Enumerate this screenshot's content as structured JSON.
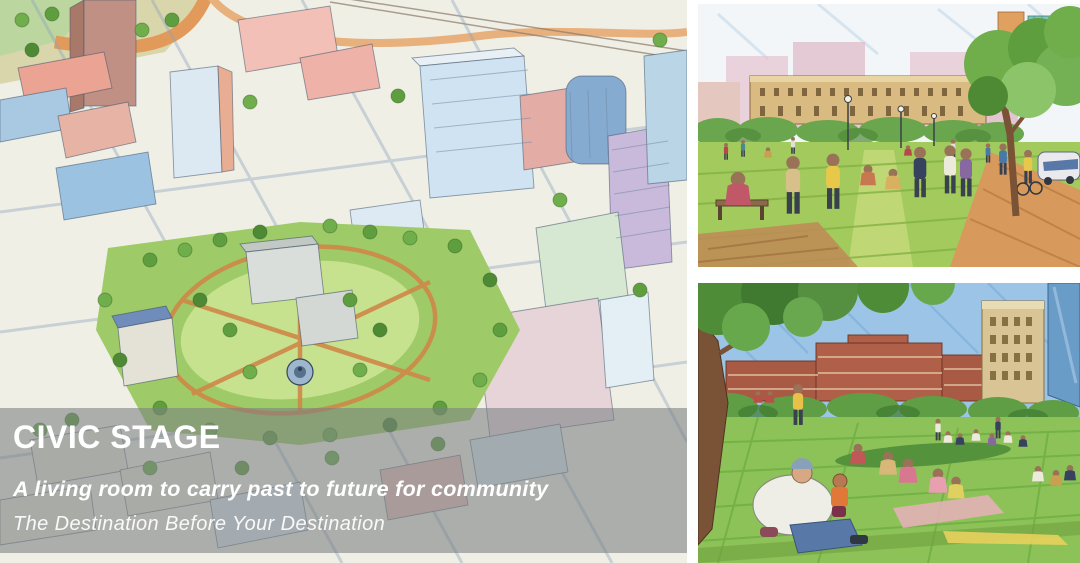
{
  "board": {
    "background_color": "#ffffff",
    "kind": "urban design concept board"
  },
  "overlay": {
    "title": "CIVIC STAGE",
    "subtitle": "A living room to carry past to future for community",
    "tagline": "The Destination Before Your Destination",
    "band_color": "rgba(123,127,130,0.58)",
    "text_color": "#ffffff"
  },
  "panels": [
    {
      "id": "aerial",
      "label": "Watercolor aerial rendering of downtown blocks surrounding a central civic park with lawns, trees, paths and a fountain"
    },
    {
      "id": "promenade",
      "label": "Watercolor street-level rendering of people strolling and gathering on the park lawn with classical buildings and towers behind"
    },
    {
      "id": "picnic",
      "label": "Watercolor rendering of families sitting and picnicking on a sloped park lawn with brick buildings and a tower in the distance"
    }
  ],
  "palette": {
    "paper": "#f4f2ea",
    "building_pale_blue": "#cfe3f2",
    "building_salmon": "#eba89b",
    "building_lavender": "#c9b9da",
    "park_green": "#9ecb67",
    "tree_green": "#5f9e3f",
    "path_orange": "#d08a48",
    "sky_blue": "#9cc4e6",
    "brick_red": "#b05a44",
    "classical_tan": "#d9ba80"
  }
}
